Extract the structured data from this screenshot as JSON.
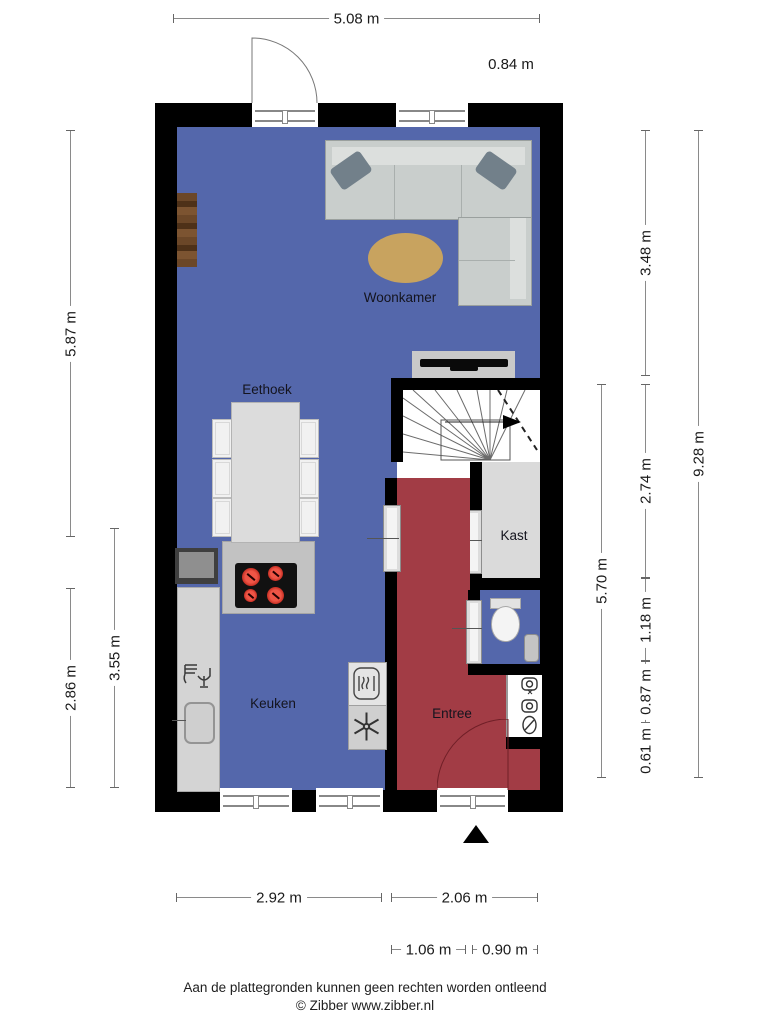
{
  "plan": {
    "rooms": [
      {
        "id": "woonkamer",
        "label": "Woonkamer"
      },
      {
        "id": "eethoek",
        "label": "Eethoek"
      },
      {
        "id": "keuken",
        "label": "Keuken"
      },
      {
        "id": "entree",
        "label": "Entree"
      },
      {
        "id": "kast",
        "label": "Kast"
      }
    ]
  },
  "dimensions": {
    "top_width": "5.08 m",
    "top_door": "0.84 m",
    "left_living": "5.87 m",
    "left_kitchen": "3.55 m",
    "left_lower": "2.86 m",
    "right_upper": "3.48 m",
    "right_stairs": "2.74 m",
    "right_toilet": "1.18 m",
    "right_meterkast": "0.87 m",
    "right_small": "0.61 m",
    "right_entree": "5.70 m",
    "right_total": "9.28 m",
    "bottom_kitchen": "2.92 m",
    "bottom_entree": "2.06 m",
    "bottom_door": "1.06 m",
    "bottom_right": "0.90 m"
  },
  "footer": {
    "disclaimer": "Aan de plattegronden kunnen geen rechten worden ontleend",
    "copyright": "© Zibber www.zibber.nl"
  },
  "colors": {
    "wall": "#000000",
    "floor": "#5467ab",
    "entree": "#a23c45",
    "rug": "#c8a35f",
    "counter_light": "#d4d4d4",
    "counter_mid": "#c2c2c2",
    "sofa": "#c9cecc",
    "sofa_pillow": "#72808a",
    "burner": "#d8382c",
    "wood": "#5e3d22",
    "dim_line": "#8a8a8a",
    "text": "#1a1a1a"
  }
}
